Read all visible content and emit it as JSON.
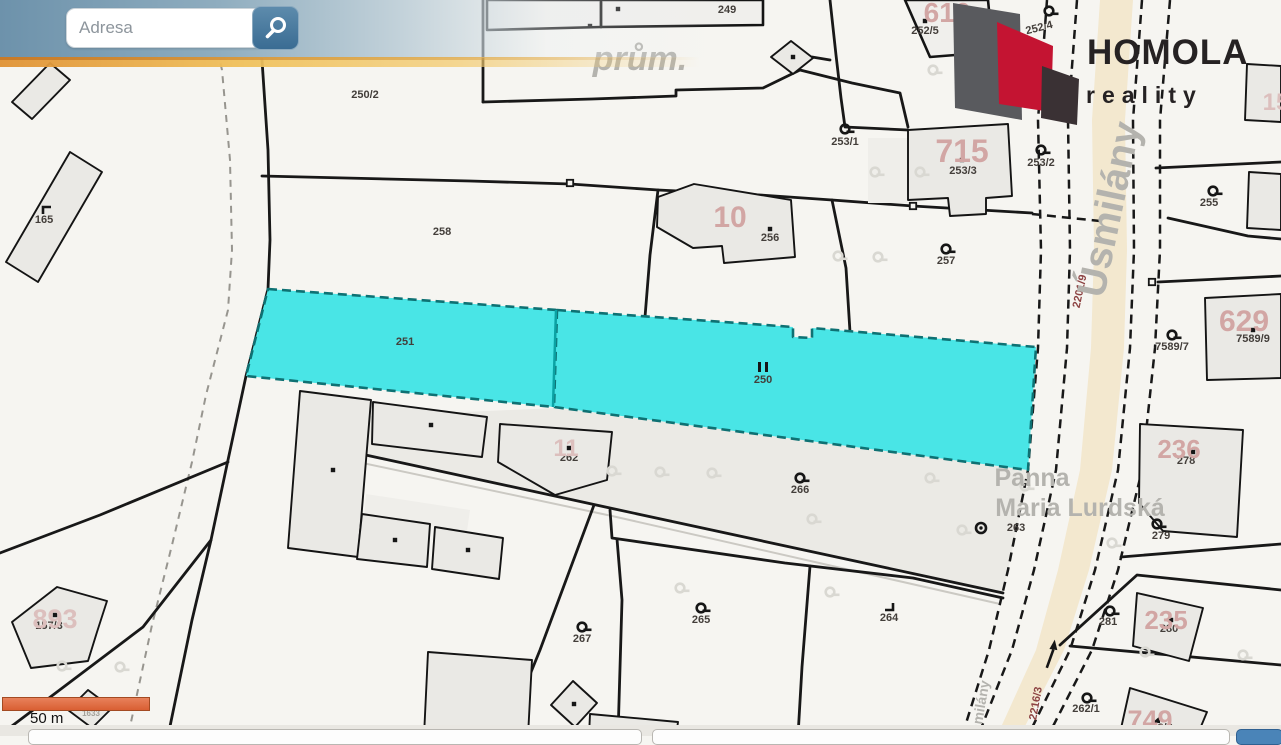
{
  "search": {
    "placeholder": "Adresa"
  },
  "logo": {
    "title": "HOMOLA",
    "subtitle": "reality",
    "colors": {
      "gray": "#595a5e",
      "red": "#c41432",
      "dark": "#3a3134"
    }
  },
  "scale_bar": {
    "label": "50 m"
  },
  "highlight": {
    "parcels": [
      "251",
      "250"
    ],
    "color": "#49e5e6"
  },
  "map": {
    "labels": [
      {
        "t": "250/2",
        "x": 365,
        "y": 98,
        "c": "parcel"
      },
      {
        "t": "165",
        "x": 44,
        "y": 223,
        "c": "parcel"
      },
      {
        "t": "258",
        "x": 442,
        "y": 235,
        "c": "parcel"
      },
      {
        "t": "249",
        "x": 727,
        "y": 13,
        "c": "parcel"
      },
      {
        "t": "252/5",
        "x": 925,
        "y": 34,
        "c": "parcel"
      },
      {
        "t": "252/4",
        "x": 1040,
        "y": 31,
        "c": "parcel",
        "r": -14
      },
      {
        "t": "253/1",
        "x": 845,
        "y": 145,
        "c": "parcel"
      },
      {
        "t": "253/3",
        "x": 963,
        "y": 174,
        "c": "parcel"
      },
      {
        "t": "253/2",
        "x": 1041,
        "y": 166,
        "c": "parcel"
      },
      {
        "t": "256",
        "x": 770,
        "y": 241,
        "c": "parcel"
      },
      {
        "t": "257",
        "x": 946,
        "y": 264,
        "c": "parcel"
      },
      {
        "t": "251",
        "x": 405,
        "y": 345,
        "c": "parcel"
      },
      {
        "t": "250",
        "x": 763,
        "y": 383,
        "c": "parcel"
      },
      {
        "t": "255",
        "x": 1209,
        "y": 206,
        "c": "parcel"
      },
      {
        "t": "7589/7",
        "x": 1172,
        "y": 350,
        "c": "parcel"
      },
      {
        "t": "7589/9",
        "x": 1253,
        "y": 342,
        "c": "parcel"
      },
      {
        "t": "266",
        "x": 800,
        "y": 493,
        "c": "parcel"
      },
      {
        "t": "262",
        "x": 569,
        "y": 461,
        "c": "parcel"
      },
      {
        "t": "267",
        "x": 582,
        "y": 642,
        "c": "parcel"
      },
      {
        "t": "265",
        "x": 701,
        "y": 623,
        "c": "parcel"
      },
      {
        "t": "264",
        "x": 889,
        "y": 621,
        "c": "parcel"
      },
      {
        "t": "278",
        "x": 1186,
        "y": 464,
        "c": "parcel"
      },
      {
        "t": "279",
        "x": 1161,
        "y": 539,
        "c": "parcel"
      },
      {
        "t": "263",
        "x": 1016,
        "y": 531,
        "c": "parcel"
      },
      {
        "t": "281",
        "x": 1108,
        "y": 625,
        "c": "parcel"
      },
      {
        "t": "280",
        "x": 1169,
        "y": 632,
        "c": "parcel"
      },
      {
        "t": "262/1",
        "x": 1086,
        "y": 712,
        "c": "parcel"
      },
      {
        "t": "262/2",
        "x": 1159,
        "y": 731,
        "c": "parcel"
      },
      {
        "t": "157/3",
        "x": 49,
        "y": 629,
        "c": "parcel"
      },
      {
        "t": "1633",
        "x": 91,
        "y": 716,
        "c": "tiny",
        "s": 8
      },
      {
        "t": "2201/9",
        "x": 1083,
        "y": 292,
        "c": "road",
        "r": -78
      },
      {
        "t": "2216/3",
        "x": 1039,
        "y": 704,
        "c": "road",
        "r": -80
      },
      {
        "t": "616",
        "x": 947,
        "y": 22,
        "c": "bldg",
        "s": 28
      },
      {
        "t": "715",
        "x": 962,
        "y": 162,
        "c": "bldg",
        "s": 32
      },
      {
        "t": "10",
        "x": 730,
        "y": 227,
        "c": "bldg",
        "s": 30
      },
      {
        "t": "629",
        "x": 1244,
        "y": 331,
        "c": "bldg",
        "s": 30
      },
      {
        "t": "236",
        "x": 1179,
        "y": 458,
        "c": "bldg",
        "s": 26
      },
      {
        "t": "235",
        "x": 1166,
        "y": 629,
        "c": "bldg",
        "s": 26
      },
      {
        "t": "749",
        "x": 1150,
        "y": 729,
        "c": "bldg",
        "s": 27
      },
      {
        "t": "893",
        "x": 55,
        "y": 628,
        "c": "bldgf",
        "s": 27
      },
      {
        "t": "11",
        "x": 566,
        "y": 456,
        "c": "bldgf",
        "s": 24
      },
      {
        "t": "15",
        "x": 1276,
        "y": 110,
        "c": "bldgf",
        "s": 24
      },
      {
        "t": "prům.",
        "x": 640,
        "y": 70,
        "c": "street",
        "s": 34,
        "i": 1
      },
      {
        "t": "Úsmilány",
        "x": 1122,
        "y": 212,
        "c": "street",
        "s": 40,
        "r": -78
      },
      {
        "t": "smilány",
        "x": 985,
        "y": 707,
        "c": "street",
        "s": 14,
        "r": -80
      },
      {
        "t": "Panna",
        "x": 1032,
        "y": 486,
        "c": "street",
        "s": 25
      },
      {
        "t": "Maria Lurdská",
        "x": 1080,
        "y": 516,
        "c": "street",
        "s": 25
      }
    ],
    "symbols": [
      {
        "k": "key",
        "x": 845,
        "y": 129
      },
      {
        "k": "key",
        "x": 1041,
        "y": 150
      },
      {
        "k": "key",
        "x": 946,
        "y": 249
      },
      {
        "k": "key",
        "x": 800,
        "y": 478
      },
      {
        "k": "key",
        "x": 701,
        "y": 608
      },
      {
        "k": "key",
        "x": 582,
        "y": 627
      },
      {
        "k": "key",
        "x": 1213,
        "y": 191
      },
      {
        "k": "key",
        "x": 1172,
        "y": 335
      },
      {
        "k": "key",
        "x": 1157,
        "y": 524
      },
      {
        "k": "key",
        "x": 1110,
        "y": 611
      },
      {
        "k": "key",
        "x": 1087,
        "y": 698
      },
      {
        "k": "key",
        "x": 1049,
        "y": 11
      },
      {
        "k": "dot",
        "x": 962,
        "y": 160
      },
      {
        "k": "dot",
        "x": 770,
        "y": 229
      },
      {
        "k": "dot",
        "x": 925,
        "y": 21
      },
      {
        "k": "dot",
        "x": 1253,
        "y": 330
      },
      {
        "k": "dot",
        "x": 1193,
        "y": 452
      },
      {
        "k": "dot",
        "x": 1171,
        "y": 620
      },
      {
        "k": "dot",
        "x": 55,
        "y": 615
      },
      {
        "k": "dot",
        "x": 569,
        "y": 448
      },
      {
        "k": "dot",
        "x": 618,
        "y": 9
      },
      {
        "k": "dot",
        "x": 590,
        "y": 26
      },
      {
        "k": "dot",
        "x": 793,
        "y": 57
      },
      {
        "k": "dot",
        "x": 333,
        "y": 470
      },
      {
        "k": "dot",
        "x": 431,
        "y": 425
      },
      {
        "k": "dot",
        "x": 395,
        "y": 540
      },
      {
        "k": "dot",
        "x": 468,
        "y": 550
      },
      {
        "k": "dot",
        "x": 92,
        "y": 708
      },
      {
        "k": "dot",
        "x": 574,
        "y": 704
      },
      {
        "k": "tri",
        "x": 1156,
        "y": 720
      },
      {
        "k": "corner",
        "x": 47,
        "y": 210
      },
      {
        "k": "corner",
        "x": 889,
        "y": 607,
        "r": 180
      },
      {
        "k": "cdot",
        "x": 981,
        "y": 528
      },
      {
        "k": "ii",
        "x": 763,
        "y": 367
      },
      {
        "k": "arrow",
        "x": 1049,
        "y": 652,
        "r": 8
      },
      {
        "k": "node",
        "x": 570,
        "y": 183
      },
      {
        "k": "node",
        "x": 913,
        "y": 206
      },
      {
        "k": "node",
        "x": 1152,
        "y": 282
      },
      {
        "k": "keyf",
        "x": 875,
        "y": 172
      },
      {
        "k": "keyf",
        "x": 920,
        "y": 172
      },
      {
        "k": "keyf",
        "x": 838,
        "y": 256
      },
      {
        "k": "keyf",
        "x": 878,
        "y": 257
      },
      {
        "k": "keyf",
        "x": 612,
        "y": 471
      },
      {
        "k": "keyf",
        "x": 660,
        "y": 472
      },
      {
        "k": "keyf",
        "x": 712,
        "y": 473
      },
      {
        "k": "keyf",
        "x": 930,
        "y": 478
      },
      {
        "k": "keyf",
        "x": 1025,
        "y": 486
      },
      {
        "k": "keyf",
        "x": 812,
        "y": 519
      },
      {
        "k": "keyf",
        "x": 962,
        "y": 530
      },
      {
        "k": "keyf",
        "x": 1112,
        "y": 543
      },
      {
        "k": "keyf",
        "x": 680,
        "y": 588
      },
      {
        "k": "keyf",
        "x": 830,
        "y": 592
      },
      {
        "k": "keyf",
        "x": 62,
        "y": 666
      },
      {
        "k": "keyf",
        "x": 120,
        "y": 667
      },
      {
        "k": "keyf",
        "x": 1145,
        "y": 652
      },
      {
        "k": "keyf",
        "x": 1243,
        "y": 655
      },
      {
        "k": "keyf",
        "x": 933,
        "y": 70
      },
      {
        "k": "keyf",
        "x": 1010,
        "y": 62
      }
    ]
  }
}
